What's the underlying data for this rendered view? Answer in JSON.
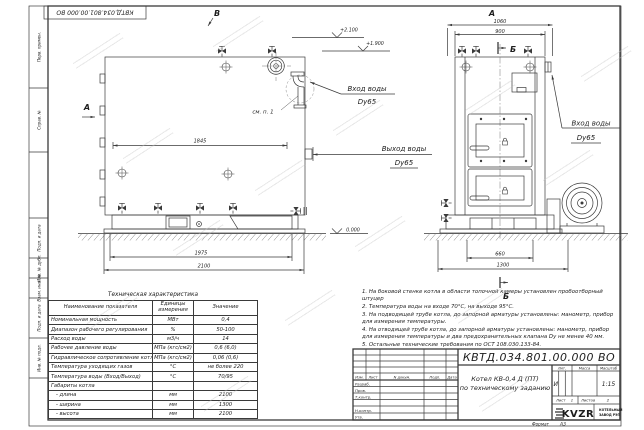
{
  "stamp": {
    "doc_number": "КВТД.034.801.00.000 ВО"
  },
  "frame": {
    "left_fields": [
      "Перв. примен.",
      "Справ. №",
      "Подп. и дата",
      "Инв. № дубл.",
      "Взам. инв. №",
      "Подп. и дата",
      "Инв. № подл."
    ],
    "format_label": "Формат",
    "format_value": "А3"
  },
  "views": {
    "left": {
      "mark_top": "В",
      "mark_side": "А",
      "elev_top": "+2.100",
      "elev_mid": "+1.900",
      "elev_zero": "0.000",
      "dim_inner": "1845",
      "dim_base": "1975",
      "dim_total": "2100",
      "detail_ref": "см. п. 1",
      "inlet_l1": "Вход воды",
      "inlet_l2": "Dy65",
      "outlet_l1": "Выход воды",
      "outlet_l2": "Dy65"
    },
    "right": {
      "mark_top": "А",
      "section_mark": "Б",
      "dim_top_outer": "1060",
      "dim_top_inner": "900",
      "dim_bot_inner": "660",
      "dim_bot_outer": "1300",
      "inlet_l1": "Вход воды",
      "inlet_l2": "Dy65"
    }
  },
  "tech_table": {
    "title": "Техническая характеристика",
    "col_name": "Наименование показателя",
    "col_units": "Единицы измерения",
    "col_value": "Значение",
    "rows": [
      {
        "name": "Номинальная мощность",
        "units": "МВт",
        "value": "0,4"
      },
      {
        "name": "Диапазон рабочего регулирования",
        "units": "%",
        "value": "50-100"
      },
      {
        "name": "Расход воды",
        "units": "м3/ч",
        "value": "14"
      },
      {
        "name": "Рабочее давление воды",
        "units": "МПа (кгс/см2)",
        "value": "0,6 (6,0)"
      },
      {
        "name": "Гидравлическое сопротивление котла",
        "units": "МПа (кгс/см2)",
        "value": "0,06 (0,6)"
      },
      {
        "name": "Температура уходящих газов",
        "units": "°С",
        "value": "не более 220"
      },
      {
        "name": "Температура воды (Вход/Выход)",
        "units": "°С",
        "value": "70/95"
      },
      {
        "name": "Габариты котла",
        "units": "",
        "value": ""
      },
      {
        "name": "   - длина",
        "units": "мм",
        "value": "2100"
      },
      {
        "name": "   - ширина",
        "units": "мм",
        "value": "1300"
      },
      {
        "name": "   - высота",
        "units": "мм",
        "value": "2100"
      }
    ]
  },
  "notes": [
    "1.  На боковой стенке котла в области топочной камеры установлен пробоотборный штуцер",
    "2.  Температура воды на входе 70°С, на выходе 95°С.",
    "3.  На подводящей трубе котла, до запорной арматуры установлены: манометр, прибор для измерения температуры.",
    "4.  На отводящей трубе котла, до запорной арматуры установлены: манометр, прибор для измерения температуры и два предохранительных клапана Dy не менее 40 мм.",
    "5.  Остальные технические требования по ОСТ 108.030.133-84."
  ],
  "title_block": {
    "doc_number": "КВТД.034.801.00.000 ВО",
    "product_title_line1": "Котел КВ-0,4 Д (ПТ)",
    "product_title_line2": "по техническому заданию",
    "header_cells": [
      "Изм.",
      "Лист",
      "N докум.",
      "Подп.",
      "Дата"
    ],
    "staff_rows": [
      "Разраб.",
      "Пров.",
      "Т.контр.",
      "Н.контр.",
      "Утв."
    ],
    "lit_label": "Лит.",
    "lit_value": "И",
    "mass_label": "Масса",
    "scale_label": "Масштаб",
    "scale_value": "1:15",
    "sheet_label": "Лист",
    "sheet_value": "1",
    "sheets_label": "Листов",
    "sheets_value": "2",
    "logo_text": "KVZR",
    "company_line1": "КОТЕЛЬНЫЙ",
    "company_line2": "ЗАВОД РЭП"
  }
}
